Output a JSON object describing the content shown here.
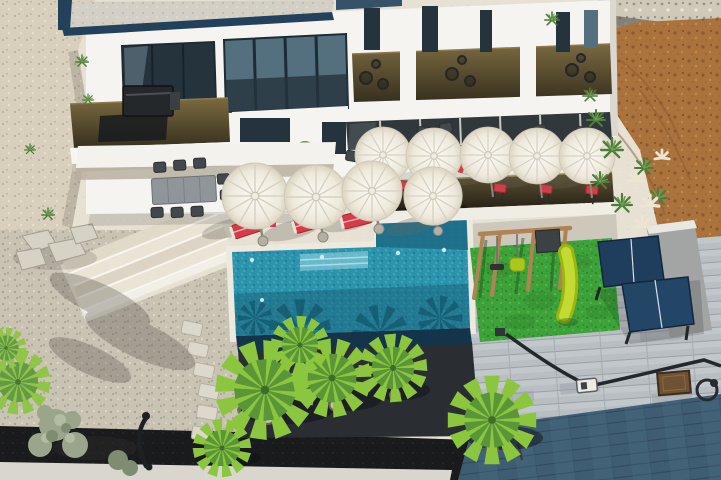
{
  "scene": {
    "type": "aerial-photograph",
    "subject": "Modern two-storey white villa with infinity pool, sun terraces, playground and palm garden",
    "inventory": {
      "parasols": 9,
      "sun_loungers_red": 3,
      "sun_loungers_white": 3,
      "bar_stools_red": 5,
      "dining_chairs": 8,
      "balcony_wire_chairs": 9,
      "palm_trees": 6,
      "olive_trees": 2,
      "swing_set": 1,
      "slide": 1,
      "table_tennis_table": 1,
      "bbq_grill": 1,
      "stepping_stones": 6,
      "stair_treads": 4,
      "pool": "L-shaped tiled infinity pool"
    }
  },
  "colors": {
    "terrace": "#e7e1d4",
    "sand": "#d8d0bc",
    "gravel": "#c9c3b4",
    "rock": "#cfc9ba",
    "dirt": "#aa733e",
    "house": "#f5f4f0",
    "roofTrim": "#24415c",
    "roofGravel": "#d4cfc4",
    "windowDark": "#25333d",
    "windowGlass": "#54707e",
    "pool": "#2b93ab",
    "poolDeep": "#1d6a84",
    "poolEdge": "#14344a",
    "coping": "#eee9de",
    "grass": "#3da23a",
    "slide": "#c3da33",
    "wood": "#b08355",
    "patio": "#b9bec2",
    "driveway": "#3f5d72",
    "asphalt": "#1a1b1d",
    "curb": "#d9d6ce",
    "deckDark": "#2a2e33",
    "palm": "#8cc63f",
    "palmDark": "#5a9638",
    "olive": "#9aa58c",
    "red": "#d63c48",
    "umbrella": "#f2efe6",
    "metal": "#2e3134",
    "pingpong": "#1f3d5c"
  }
}
